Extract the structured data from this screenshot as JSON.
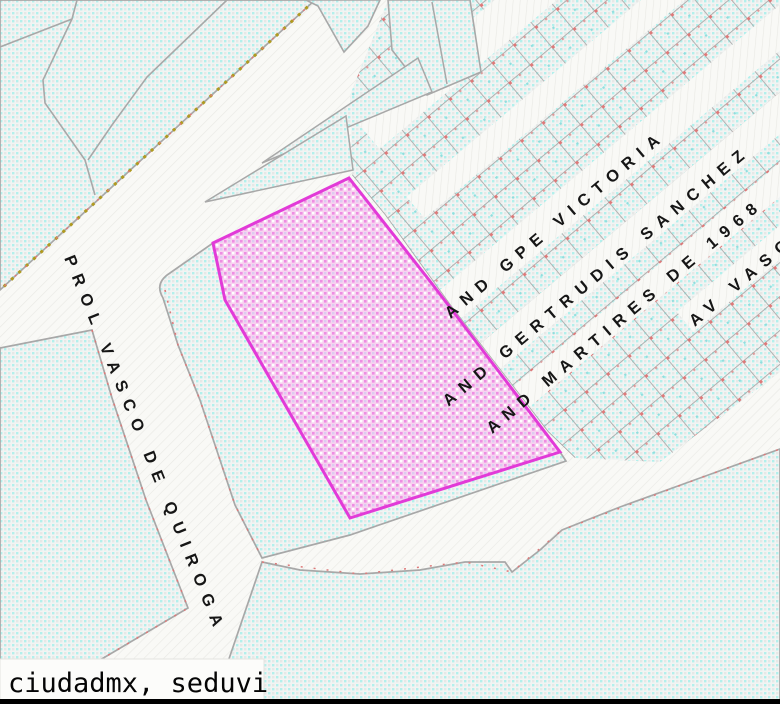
{
  "map": {
    "title": "cadastral-map-view",
    "streets": [
      {
        "name": "PROL VASCO DE QUIROGA"
      },
      {
        "name": "AND GPE VICTORIA"
      },
      {
        "name": "AND GERTRUDIS SANCHEZ"
      },
      {
        "name": "AND MARTIRES DE 1968"
      },
      {
        "name": "AV VASCO DE"
      }
    ],
    "highlighted_parcel": {
      "status": "selected",
      "fill": "#f6cdef",
      "border": "#e23ad8"
    },
    "attribution": "ciudadmx, seduvi",
    "colors": {
      "parcel_dot": "#b2f0ec",
      "parcel_base": "#f2f4f3",
      "street_base": "#f9f9f6",
      "boundary_gray": "#a8a8a8",
      "boundary_red_accent": "#dd7a7a",
      "edge_olive_accent": "#b09a20",
      "bottom_border": "#000000"
    }
  }
}
